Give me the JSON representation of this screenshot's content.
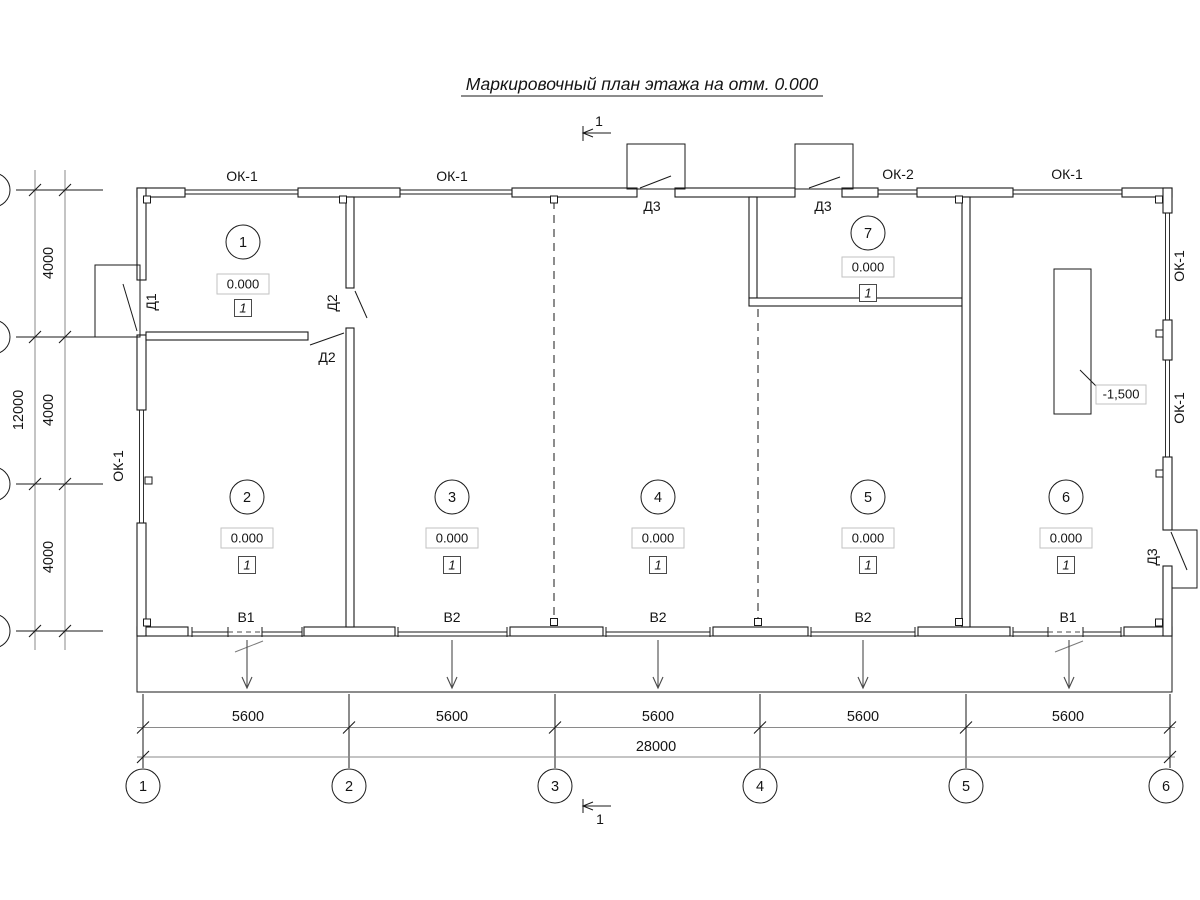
{
  "title": "Маркировочный план этажа на отм. 0.000",
  "colors": {
    "background": "#ffffff",
    "line": "#1a1a1a",
    "light_box_border": "#c2c2c2"
  },
  "section_marks": {
    "top_label": "1",
    "bottom_label": "1"
  },
  "window_labels": {
    "ok1": "ОК-1",
    "ok2": "ОК-2"
  },
  "door_labels": {
    "d1": "Д1",
    "d2": "Д2",
    "d3": "Д3"
  },
  "pit": {
    "elevation": "-1,500"
  },
  "rooms": [
    {
      "number": "1",
      "elevation": "0.000",
      "finish_type": "1"
    },
    {
      "number": "2",
      "elevation": "0.000",
      "finish_type": "1"
    },
    {
      "number": "3",
      "elevation": "0.000",
      "finish_type": "1"
    },
    {
      "number": "4",
      "elevation": "0.000",
      "finish_type": "1"
    },
    {
      "number": "5",
      "elevation": "0.000",
      "finish_type": "1"
    },
    {
      "number": "6",
      "elevation": "0.000",
      "finish_type": "1"
    },
    {
      "number": "7",
      "elevation": "0.000",
      "finish_type": "1"
    }
  ],
  "bottom_openings": [
    {
      "label": "В1"
    },
    {
      "label": "В2"
    },
    {
      "label": "В2"
    },
    {
      "label": "В2"
    },
    {
      "label": "В1"
    }
  ],
  "dimensions": {
    "bays": [
      "5600",
      "5600",
      "5600",
      "5600",
      "5600"
    ],
    "total": "28000",
    "rows": [
      "4000",
      "4000",
      "4000"
    ],
    "rows_total": "12000"
  },
  "grid": {
    "columns": [
      "1",
      "2",
      "3",
      "4",
      "5",
      "6"
    ]
  }
}
